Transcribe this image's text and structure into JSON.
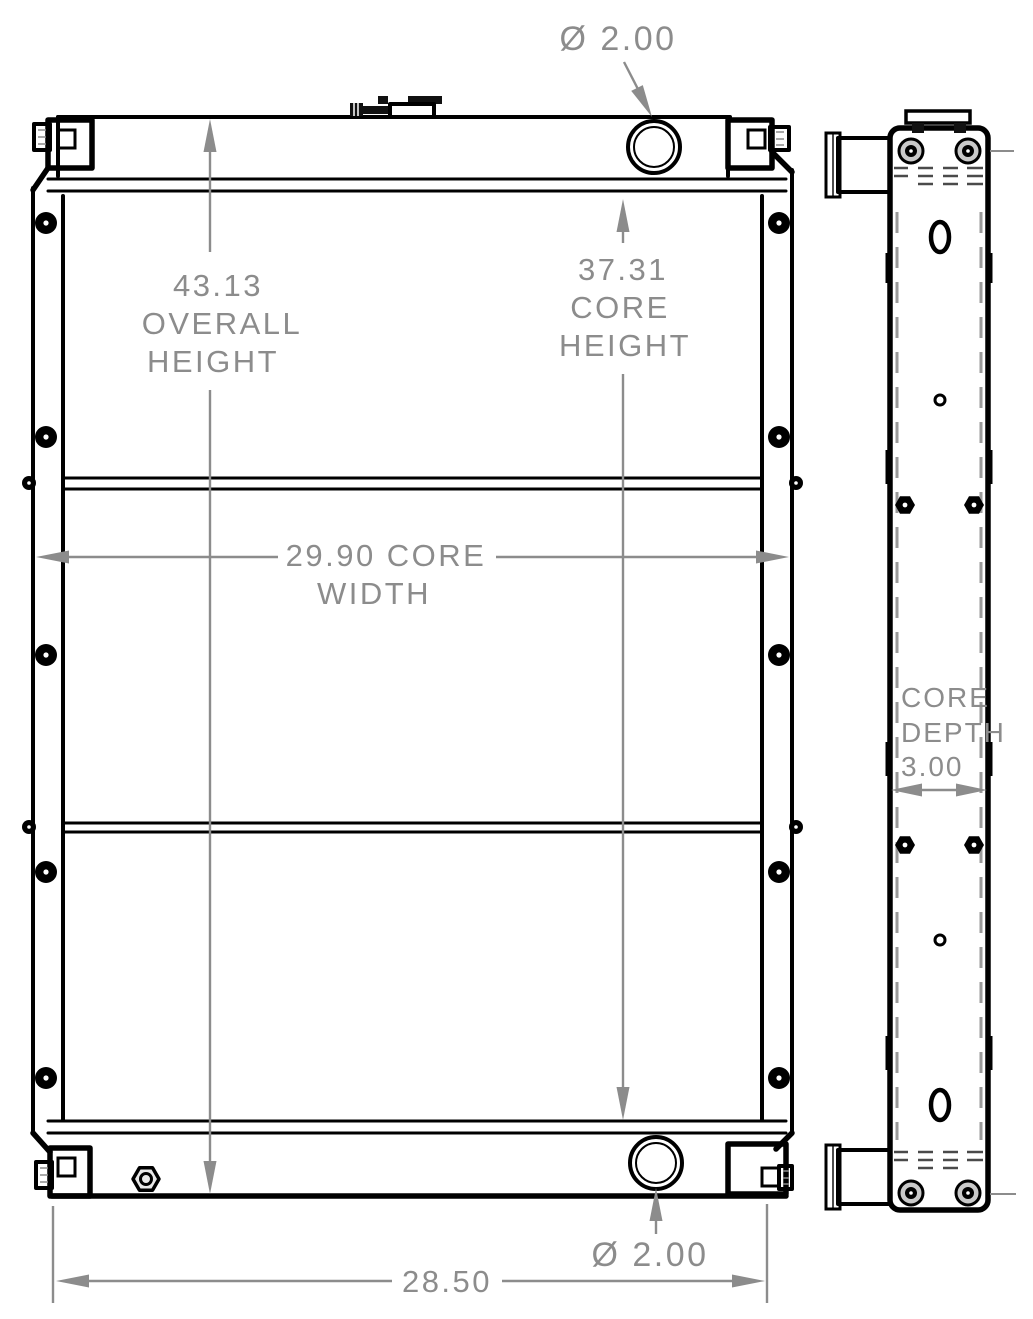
{
  "drawing": {
    "kind": "radiator-dimension-drawing",
    "colors": {
      "line": "#000000",
      "dimension": "#8c8c8c",
      "background": "#ffffff"
    },
    "dimensions": {
      "top_port_diameter": "Ø 2.00",
      "overall_height": {
        "value": "43.13",
        "label1": "OVERALL",
        "label2": "HEIGHT"
      },
      "core_height": {
        "value": "37.31",
        "label1": "CORE",
        "label2": "HEIGHT"
      },
      "core_width": {
        "line1": "29.90 CORE",
        "line2": "WIDTH"
      },
      "core_depth": {
        "label1": "CORE",
        "label2": "DEPTH",
        "value": "3.00"
      },
      "bottom_port_diameter": "Ø 2.00",
      "mounting_width": "28.50"
    }
  }
}
